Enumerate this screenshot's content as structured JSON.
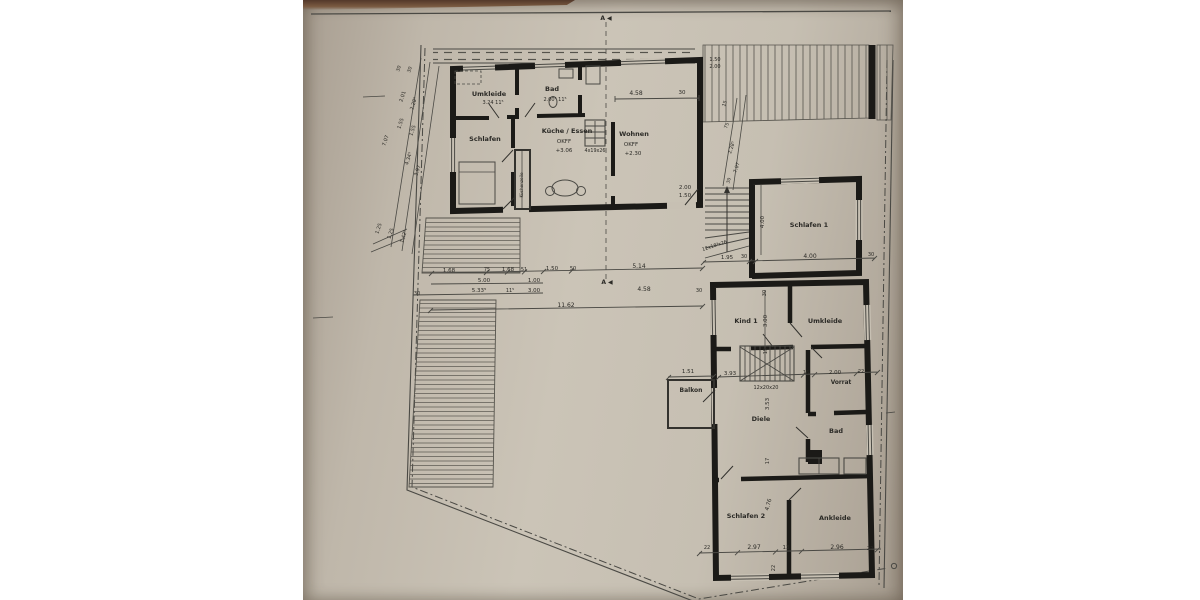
{
  "photo": {
    "description": "photographed architectural floor plan (Dachgeschoss/OG) on grey paper",
    "colors": {
      "paper": "#c6bfb2",
      "line": "#2b2a26",
      "wall": "#1b1a17",
      "top_strip": "#5a4330",
      "margin": "#ffffff"
    }
  },
  "plan": {
    "section_marker": "A ◀",
    "labels": [
      {
        "n": "section-marker-top",
        "t": "A ◀",
        "x": 303,
        "y": 20,
        "s": 6,
        "w": 700
      },
      {
        "n": "section-marker-mid",
        "t": "A ◀",
        "x": 304,
        "y": 284,
        "s": 6,
        "w": 700
      },
      {
        "n": "room-umkleide-upper",
        "t": "Umkleide",
        "x": 186,
        "y": 96,
        "s": 6.5,
        "w": 700
      },
      {
        "n": "dim-label",
        "t": "3.24  11⁵",
        "x": 190,
        "y": 104,
        "s": 5
      },
      {
        "n": "room-bad-upper",
        "t": "Bad",
        "x": 249,
        "y": 91,
        "s": 6.5,
        "w": 700
      },
      {
        "n": "dim-label",
        "t": "2.00⁵  11⁵",
        "x": 252,
        "y": 101,
        "s": 5
      },
      {
        "n": "room-schlafen-upper",
        "t": "Schlafen",
        "x": 182,
        "y": 141,
        "s": 6.5,
        "w": 700
      },
      {
        "n": "room-kueche-essen",
        "t": "Küche / Essen",
        "x": 264,
        "y": 133,
        "s": 6.5,
        "w": 700
      },
      {
        "n": "kueche-okff",
        "t": "OKFF",
        "x": 261,
        "y": 143,
        "s": 5.5
      },
      {
        "n": "kueche-level",
        "t": "+3.06",
        "x": 261,
        "y": 152,
        "s": 5.5
      },
      {
        "n": "stairs-4x19x26",
        "t": "4x19x26",
        "x": 292,
        "y": 152,
        "s": 4.8
      },
      {
        "n": "room-wohnen",
        "t": "Wohnen",
        "x": 331,
        "y": 136,
        "s": 6.5,
        "w": 700
      },
      {
        "n": "wohnen-okff",
        "t": "OKFF",
        "x": 328,
        "y": 146,
        "s": 5.5
      },
      {
        "n": "wohnen-level",
        "t": "+2.30",
        "x": 330,
        "y": 155,
        "s": 5.5
      },
      {
        "n": "kitchen-unit-label",
        "t": "Küchenzeile",
        "x": 220,
        "y": 185,
        "s": 4.2,
        "r": -90
      },
      {
        "n": "dim-label",
        "t": "4.58",
        "x": 333,
        "y": 95,
        "s": 6
      },
      {
        "n": "dim-label",
        "t": "30",
        "x": 379,
        "y": 94,
        "s": 5.5
      },
      {
        "n": "dim-label",
        "t": "2.00",
        "x": 382,
        "y": 189,
        "s": 5.5
      },
      {
        "n": "dim-label",
        "t": "1.50",
        "x": 382,
        "y": 197,
        "s": 5.5
      },
      {
        "n": "dim-label",
        "t": "1.50",
        "x": 412,
        "y": 61,
        "s": 5
      },
      {
        "n": "dim-label",
        "t": "2.00",
        "x": 412,
        "y": 68,
        "s": 5
      },
      {
        "n": "dim-label",
        "t": "30",
        "x": 97,
        "y": 69,
        "s": 4.8,
        "r": -72
      },
      {
        "n": "dim-label",
        "t": "30",
        "x": 108,
        "y": 70,
        "s": 4.8,
        "r": -72
      },
      {
        "n": "dim-label",
        "t": "2.01",
        "x": 101,
        "y": 97,
        "s": 5,
        "r": -72
      },
      {
        "n": "dim-label",
        "t": "2.28⁵",
        "x": 112,
        "y": 104,
        "s": 5,
        "r": -72
      },
      {
        "n": "dim-label",
        "t": "1.55",
        "x": 99,
        "y": 124,
        "s": 5,
        "r": -72
      },
      {
        "n": "dim-label",
        "t": "1.55",
        "x": 111,
        "y": 131,
        "s": 5,
        "r": -72
      },
      {
        "n": "dim-label",
        "t": "7.07",
        "x": 84,
        "y": 141,
        "s": 5,
        "r": -72
      },
      {
        "n": "dim-label",
        "t": "4.34⁵",
        "x": 107,
        "y": 159,
        "s": 5,
        "r": -72
      },
      {
        "n": "dim-label",
        "t": "3.97",
        "x": 116,
        "y": 171,
        "s": 5,
        "r": -72
      },
      {
        "n": "dim-label",
        "t": "1.25",
        "x": 77,
        "y": 229,
        "s": 5,
        "r": -72
      },
      {
        "n": "dim-label",
        "t": "1.25",
        "x": 89,
        "y": 234,
        "s": 5,
        "r": -72
      },
      {
        "n": "dim-label",
        "t": "1.42⁵",
        "x": 102,
        "y": 237,
        "s": 5,
        "r": -72
      },
      {
        "n": "dim-label",
        "t": "15",
        "x": 423,
        "y": 104,
        "s": 4.8,
        "r": -72
      },
      {
        "n": "dim-label",
        "t": "75",
        "x": 425,
        "y": 126,
        "s": 4.8,
        "r": -72
      },
      {
        "n": "dim-label",
        "t": "2.28⁵",
        "x": 430,
        "y": 148,
        "s": 4.8,
        "r": -72
      },
      {
        "n": "dim-label",
        "t": "7.07",
        "x": 435,
        "y": 168,
        "s": 4.8,
        "r": -72
      },
      {
        "n": "dim-label",
        "t": "30",
        "x": 427,
        "y": 181,
        "s": 4.5,
        "r": -72
      },
      {
        "n": "dim-label",
        "t": "1.68",
        "x": 146,
        "y": 272,
        "s": 5.5
      },
      {
        "n": "dim-label",
        "t": "75",
        "x": 184,
        "y": 271,
        "s": 5
      },
      {
        "n": "dim-label",
        "t": "1.68",
        "x": 205,
        "y": 271,
        "s": 5.5
      },
      {
        "n": "dim-label",
        "t": "51",
        "x": 221,
        "y": 271,
        "s": 5
      },
      {
        "n": "dim-label",
        "t": "1.50",
        "x": 249,
        "y": 270,
        "s": 5.5
      },
      {
        "n": "dim-label",
        "t": "50",
        "x": 270,
        "y": 270,
        "s": 5
      },
      {
        "n": "dim-label",
        "t": "5.14",
        "x": 336,
        "y": 268,
        "s": 6
      },
      {
        "n": "dim-label",
        "t": "5.00",
        "x": 181,
        "y": 282,
        "s": 5.5
      },
      {
        "n": "dim-label",
        "t": "1.00",
        "x": 231,
        "y": 282,
        "s": 5.5
      },
      {
        "n": "dim-label",
        "t": "30",
        "x": 114,
        "y": 295,
        "s": 5
      },
      {
        "n": "dim-label",
        "t": "5.33⁵",
        "x": 176,
        "y": 292,
        "s": 5.5
      },
      {
        "n": "dim-label",
        "t": "11⁵",
        "x": 207,
        "y": 292,
        "s": 5
      },
      {
        "n": "dim-label",
        "t": "3.00",
        "x": 231,
        "y": 292,
        "s": 5.5
      },
      {
        "n": "dim-label",
        "t": "4.58",
        "x": 341,
        "y": 291,
        "s": 6
      },
      {
        "n": "dim-label",
        "t": "30",
        "x": 396,
        "y": 292,
        "s": 5
      },
      {
        "n": "dim-label",
        "t": "11.62",
        "x": 263,
        "y": 307,
        "s": 6
      },
      {
        "n": "stairs-12x18x26",
        "t": "12x18³x26",
        "x": 412,
        "y": 247,
        "s": 4.8,
        "r": -18
      },
      {
        "n": "room-schlafen-1",
        "t": "Schlafen 1",
        "x": 506,
        "y": 227,
        "s": 6.5,
        "w": 700
      },
      {
        "n": "dim-label",
        "t": "4.00",
        "x": 461,
        "y": 222,
        "s": 5.5,
        "r": -90
      },
      {
        "n": "dim-label",
        "t": "1.95",
        "x": 424,
        "y": 259,
        "s": 5.5
      },
      {
        "n": "dim-label",
        "t": "30",
        "x": 441,
        "y": 258,
        "s": 5
      },
      {
        "n": "dim-label",
        "t": "4.00",
        "x": 507,
        "y": 258,
        "s": 6
      },
      {
        "n": "dim-label",
        "t": "30",
        "x": 568,
        "y": 256,
        "s": 5
      },
      {
        "n": "room-kind-1",
        "t": "Kind 1",
        "x": 443,
        "y": 323,
        "s": 6.5,
        "w": 700
      },
      {
        "n": "room-umkleide-right",
        "t": "Umkleide",
        "x": 522,
        "y": 323,
        "s": 6.5,
        "w": 700
      },
      {
        "n": "dim-label",
        "t": "30",
        "x": 463,
        "y": 293,
        "s": 5,
        "r": -90
      },
      {
        "n": "dim-label",
        "t": "3.00",
        "x": 464,
        "y": 321,
        "s": 5.5,
        "r": -90
      },
      {
        "n": "dim-label",
        "t": "15",
        "x": 464,
        "y": 351,
        "s": 5,
        "r": -90
      },
      {
        "n": "dim-label",
        "t": "3.93",
        "x": 427,
        "y": 375,
        "s": 5.5
      },
      {
        "n": "dim-label",
        "t": "16",
        "x": 503,
        "y": 374,
        "s": 5
      },
      {
        "n": "dim-label",
        "t": "2.00",
        "x": 532,
        "y": 374,
        "s": 5.5
      },
      {
        "n": "dim-label",
        "t": "22",
        "x": 558,
        "y": 373,
        "s": 5
      },
      {
        "n": "room-vorrat",
        "t": "Vorrat",
        "x": 538,
        "y": 384,
        "s": 5.8,
        "w": 700
      },
      {
        "n": "stairs-12x20x20",
        "t": "12x20x20",
        "x": 463,
        "y": 389,
        "s": 5
      },
      {
        "n": "dim-label",
        "t": "1.51",
        "x": 385,
        "y": 373,
        "s": 5.5
      },
      {
        "n": "room-balkon",
        "t": "Balkon",
        "x": 388,
        "y": 392,
        "s": 6,
        "w": 700
      },
      {
        "n": "room-diele",
        "t": "Diele",
        "x": 458,
        "y": 421,
        "s": 6.5,
        "w": 700
      },
      {
        "n": "dim-label",
        "t": "3.53",
        "x": 466,
        "y": 404,
        "s": 5.5,
        "r": -90
      },
      {
        "n": "dim-label",
        "t": "17",
        "x": 466,
        "y": 461,
        "s": 5,
        "r": -90
      },
      {
        "n": "room-bad-right",
        "t": "Bad",
        "x": 533,
        "y": 433,
        "s": 6.5,
        "w": 700
      },
      {
        "n": "room-schlafen-2",
        "t": "Schlafen 2",
        "x": 443,
        "y": 518,
        "s": 6.5,
        "w": 700
      },
      {
        "n": "dim-label",
        "t": "4.76",
        "x": 467,
        "y": 505,
        "s": 5.5,
        "r": -75
      },
      {
        "n": "room-ankleide",
        "t": "Ankleide",
        "x": 532,
        "y": 520,
        "s": 6.5,
        "w": 700
      },
      {
        "n": "dim-label",
        "t": "22",
        "x": 404,
        "y": 549,
        "s": 5
      },
      {
        "n": "dim-label",
        "t": "2.97",
        "x": 451,
        "y": 549,
        "s": 6
      },
      {
        "n": "dim-label",
        "t": "13",
        "x": 483,
        "y": 549,
        "s": 5.5
      },
      {
        "n": "dim-label",
        "t": "2.96",
        "x": 534,
        "y": 549,
        "s": 6
      },
      {
        "n": "dim-label",
        "t": "22",
        "x": 567,
        "y": 550,
        "s": 5
      },
      {
        "n": "dim-label",
        "t": "22",
        "x": 472,
        "y": 568,
        "s": 5,
        "r": -90
      }
    ]
  }
}
